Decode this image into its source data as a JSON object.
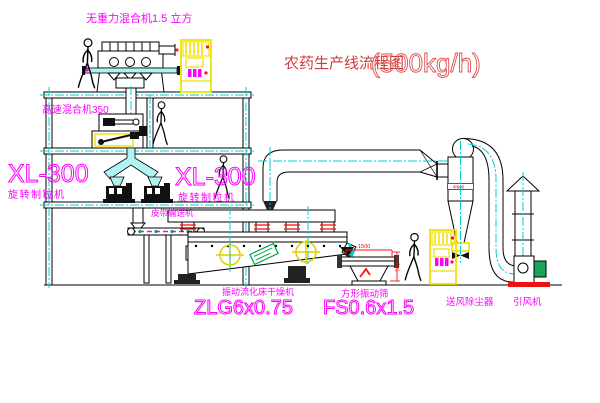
{
  "title": {
    "name": "农药生产线流程图",
    "capacity": "(500kg/h)"
  },
  "equipment": {
    "gravity_mixer": {
      "label": "无重力混合机1.5 立方"
    },
    "high_speed_mixer": {
      "label": "高速混合机350"
    },
    "granulator_left": {
      "model": "XL-300",
      "name": "旋转制粒机"
    },
    "granulator_right": {
      "model": "XL-300",
      "name": "旋转制粒机"
    },
    "belt_conveyor": {
      "label": "皮带输送机"
    },
    "fluid_bed_dryer": {
      "name": "振动流化床干燥机",
      "model": "ZLG6x0.75"
    },
    "vibrating_screen": {
      "name": "方形振动筛",
      "model": "FS0.6x1.5"
    },
    "air_dust_collector": {
      "label": "送风除尘器"
    },
    "induced_draft_fan": {
      "label": "引风机"
    }
  },
  "dimensions": {
    "screen_length": "1500",
    "screen_height": "745",
    "cyclone_inlet": "Φ600"
  },
  "colors": {
    "outline": "#000000",
    "pipe_cyan": "#00d0d0",
    "label_magenta": "#ff00ff",
    "title_red": "#d23b3b",
    "dimension_red": "#ff0000",
    "cabinet_yellow": "#f0e000",
    "motor_green": "#18a558"
  }
}
